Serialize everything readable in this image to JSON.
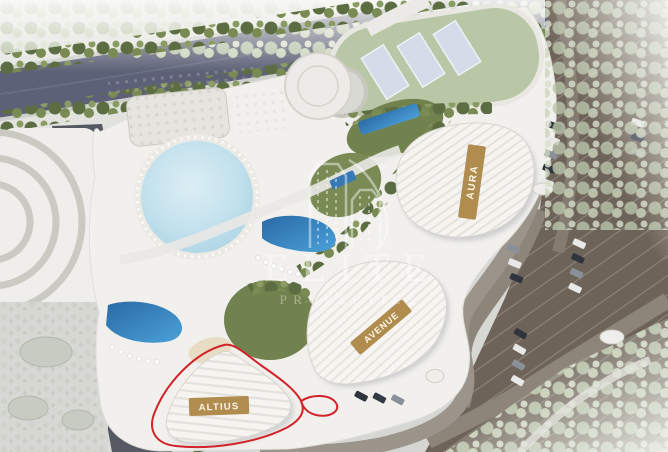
{
  "watermark": {
    "line1": "ELITE",
    "line2": "PROPERTIES"
  },
  "buildings": [
    {
      "name": "aura",
      "label": "AURA",
      "highlighted": false
    },
    {
      "name": "avenue",
      "label": "AVENUE",
      "highlighted": false
    },
    {
      "name": "altius",
      "label": "ALTIUS",
      "highlighted": true
    }
  ],
  "colors": {
    "banner_gold": "#b08c4e",
    "banner_text": "#fdf7ea",
    "plot_outline_red": "#d2232a",
    "pool_blue": "#2f78b5",
    "lagoon_blue": "#bfe0ec",
    "lawn_green": "#b9c7a7",
    "tree_green": "#5c6e41",
    "road_dark": "#5d6177",
    "parking_brown": "#6e6358",
    "site_white": "#f1f0ec",
    "watermark_white": "#ffffff"
  }
}
